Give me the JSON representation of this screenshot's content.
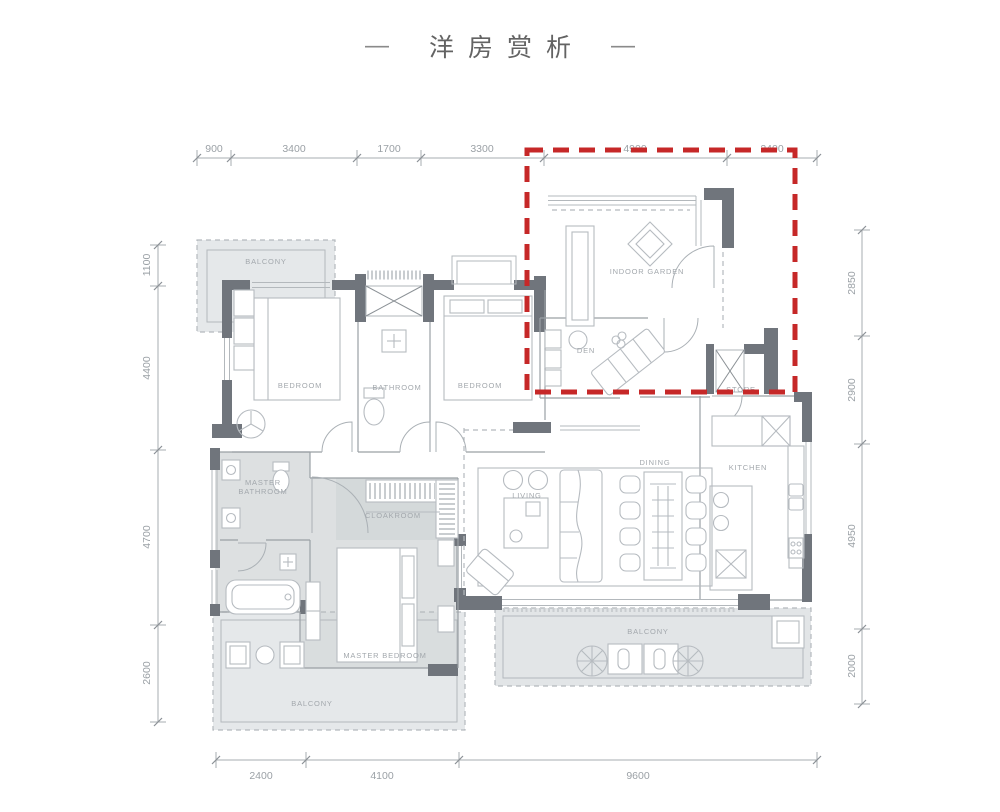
{
  "page": {
    "title": "洋房赏析",
    "title_dash_left": "—",
    "title_dash_right": "—"
  },
  "dimensions": {
    "top": [
      "900",
      "3400",
      "1700",
      "3300",
      "4900",
      "2400"
    ],
    "left": [
      "1100",
      "4400",
      "4700",
      "2600"
    ],
    "right": [
      "2850",
      "2900",
      "4950",
      "2000"
    ],
    "bottom": [
      "2400",
      "4100",
      "9600"
    ]
  },
  "rooms": {
    "balcony_top": "BALCONY",
    "bedroom_left": "BEDROOM",
    "bathroom": "BATHROOM",
    "bedroom_mid": "BEDROOM",
    "indoor_garden": "INDOOR GARDEN",
    "den": "DEN",
    "store": "STORE",
    "kitchen": "KITCHEN",
    "dining": "DINING",
    "living": "LIVING",
    "master_bath_line1": "MASTER",
    "master_bath_line2": "BATHROOM",
    "cloakroom": "CLOAKROOM",
    "master_bedroom": "MASTER BEDROOM",
    "balcony_bottom_left": "BALCONY",
    "balcony_bottom_right": "BALCONY"
  },
  "colors": {
    "highlight_red": "#c62828",
    "wall_gray": "#70757c",
    "fill_light": "#e5e8ea",
    "fill_master": "#d7dadc",
    "dim_gray": "#9ba1a6"
  }
}
